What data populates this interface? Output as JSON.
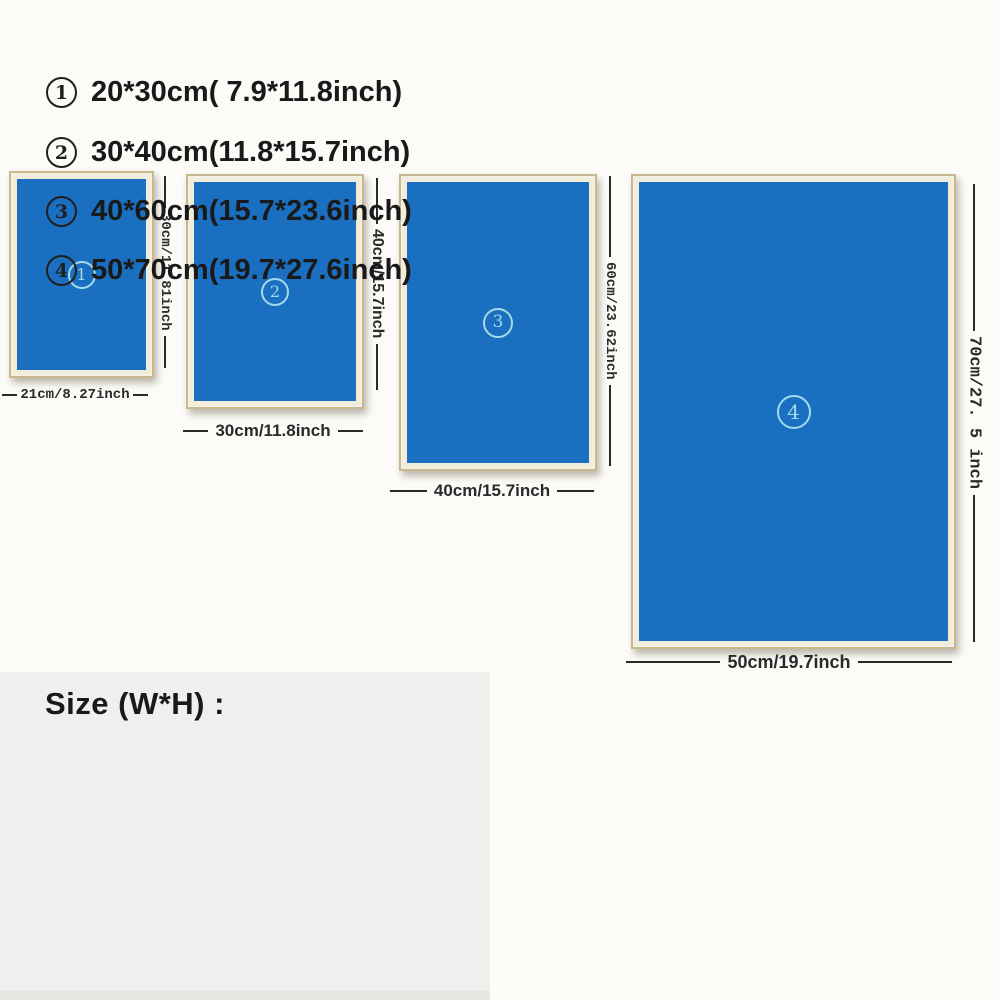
{
  "palette": {
    "canvas_blue": "#1b6fc0",
    "frame_tan": "#c9b78f",
    "frame_mat": "#f2ecdb",
    "badge_cyan": "#a2dbea",
    "dimension_ink": "#2a2a2a",
    "legend_bg": "#f1efed",
    "page_bg": "#fcfbf8"
  },
  "posters": [
    {
      "num": "1",
      "height_label": "30cm/11.81inch",
      "width_label": "21cm/8.27inch"
    },
    {
      "num": "2",
      "height_label": "40cm/15.7inch",
      "width_label": "30cm/11.8inch"
    },
    {
      "num": "3",
      "height_label": "60cm/23.62inch",
      "width_label": "40cm/15.7inch"
    },
    {
      "num": "4",
      "height_label": "70cm/27. 5 inch",
      "width_label": "50cm/19.7inch"
    }
  ],
  "legend": {
    "title": "Size (W*H) :",
    "items": [
      {
        "num": "1",
        "text": "20*30cm( 7.9*11.8inch)"
      },
      {
        "num": "2",
        "text": "30*40cm(11.8*15.7inch)"
      },
      {
        "num": "3",
        "text": "40*60cm(15.7*23.6inch)"
      },
      {
        "num": "4",
        "text": "50*70cm(19.7*27.6inch)"
      }
    ]
  }
}
